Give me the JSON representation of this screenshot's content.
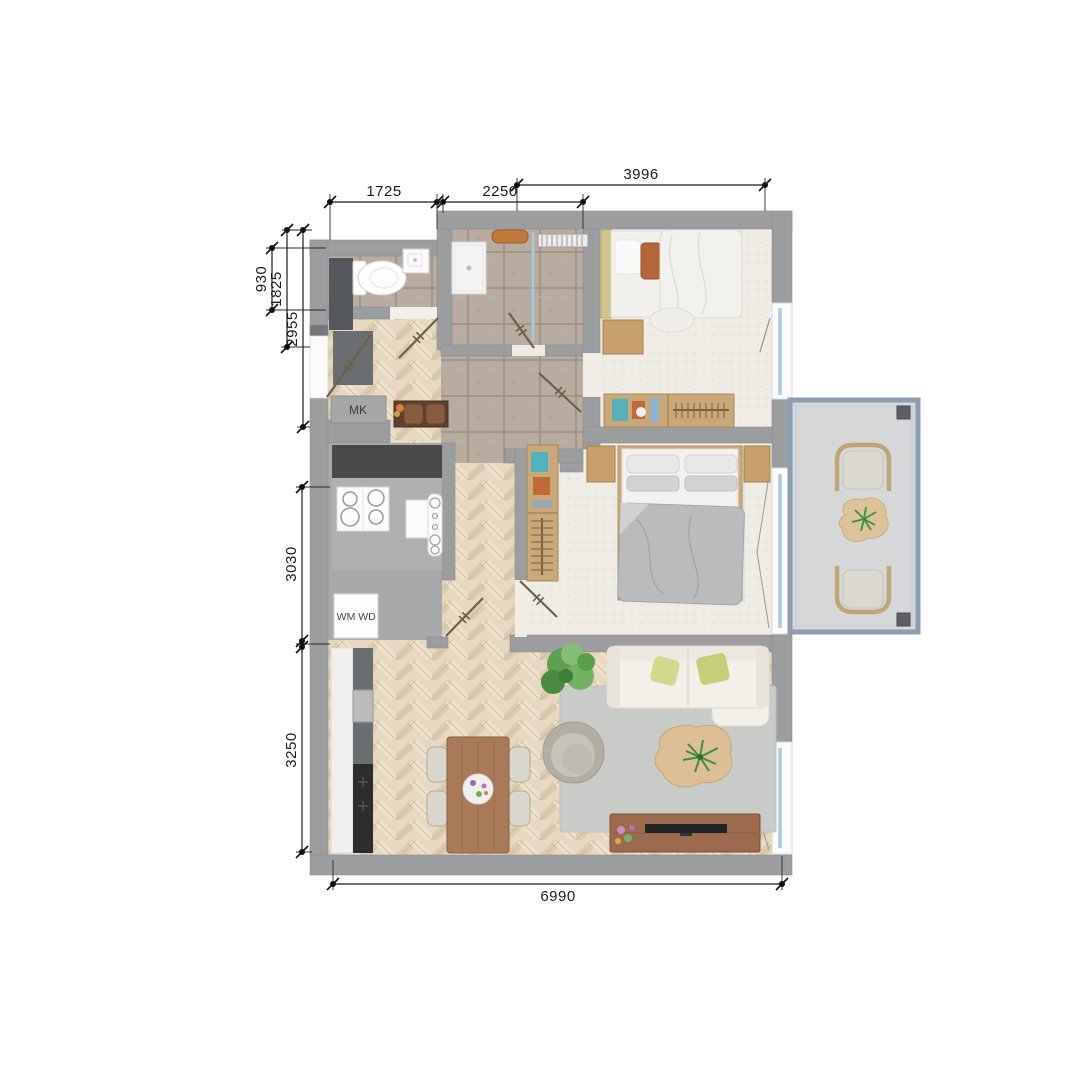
{
  "canvas": {
    "width": 1092,
    "height": 1092,
    "background": "#ffffff"
  },
  "dims": {
    "t0": "1725",
    "t1": "2250",
    "t2": "3996",
    "l0": "930",
    "l1": "1825",
    "l2": "2955",
    "l3": "3030",
    "l4": "3250",
    "b0": "6990"
  },
  "labels": {
    "mk": "MK",
    "wm": "WM",
    "wd": "WD"
  },
  "icons": {
    "dimension_marker": "dot-with-slash-tick",
    "door_swing": "diagonal-leaf-with-ticks",
    "window": "blue-glass-strip"
  },
  "colors": {
    "wall": "#9b9d9f",
    "wood_floor": "#e7d8c2",
    "tile_floor": "#b3a89d",
    "carpet": "#efece6",
    "kitchen_floor": "#a7a9ab",
    "balcony_deck": "#d6d7d8",
    "balcony_frame": "#8c9cb1",
    "glass": "#a9cade",
    "dimension_ink": "#1b1b1b",
    "door_leaf": "#6b6148",
    "furniture_wood": "#c9a87a",
    "dark_cabinet": "#47494b",
    "sofa": "#f3f0ea",
    "rug": "#c9cbc9",
    "duvet_gray": "#b9bbbd",
    "pillow_orange": "#b5653a",
    "pillow_green": "#ccd37f",
    "plant_green": "#5f9e53",
    "dining_table": "#a97a5a",
    "tv_console": "#9c6b4f"
  }
}
